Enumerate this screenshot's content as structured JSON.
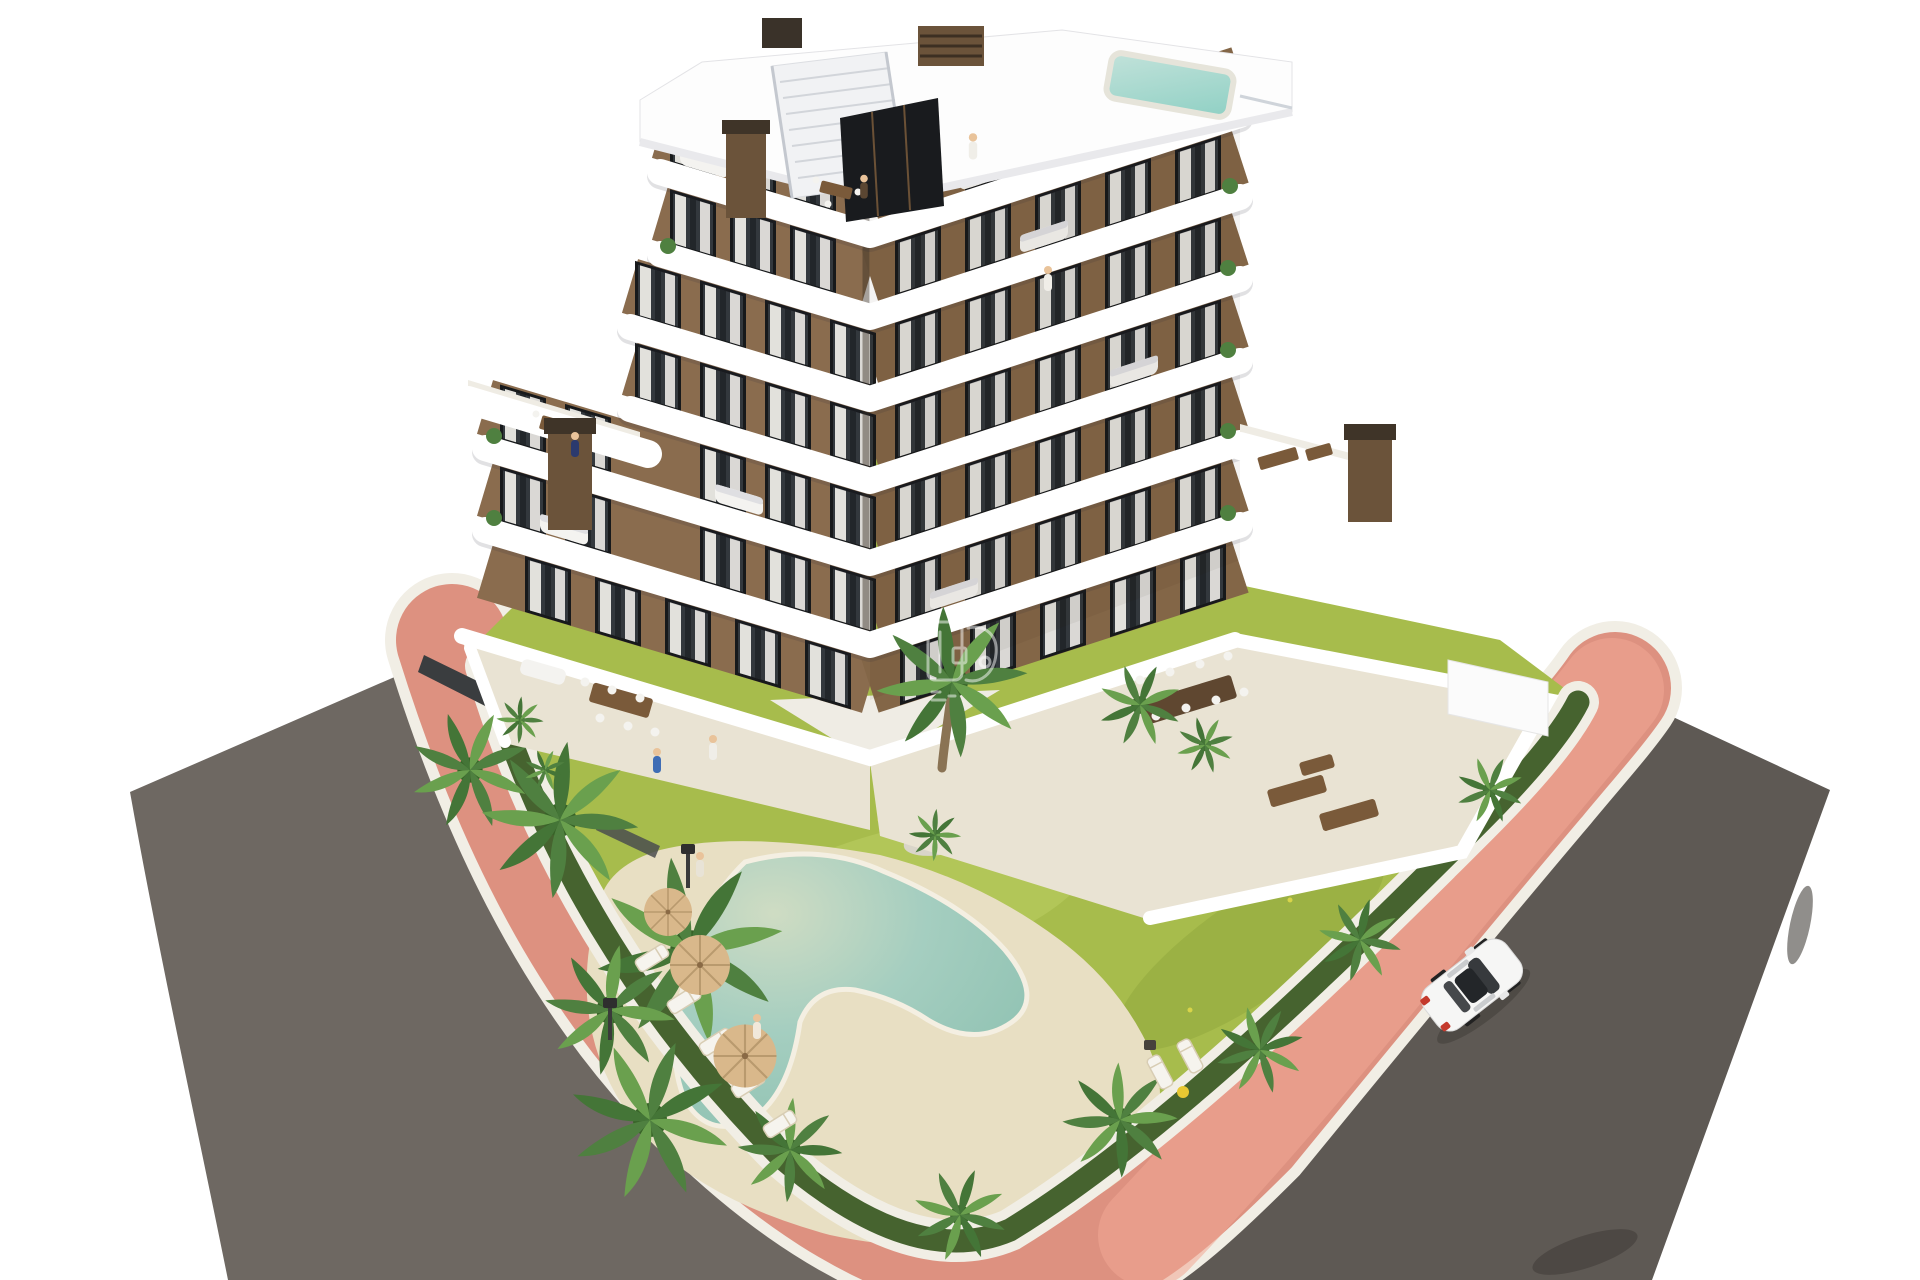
{
  "scene": {
    "title": "aerial-3d-render-of-apartment-residence-with-pool-garden-and-streets",
    "background": "#ffffff"
  },
  "palette": {
    "bg": "#ffffff",
    "road_left": "#6e6862",
    "road_right": "#5e5954",
    "sidewalk_pink": "#dd9180",
    "sidewalk_pink_light": "#f0a894",
    "curb_white": "#f1eee5",
    "lawn": "#a7bc4c",
    "lawn_light": "#bccd63",
    "lawn_dark": "#90a63c",
    "hedge": "#46632f",
    "palm_green": "#4f8040",
    "palm_light": "#6aa04e",
    "palm_dark": "#386328",
    "deck_sand": "#e8dfc3",
    "pool_shallow": "#cfdcc3",
    "pool_water": "#a5cec0",
    "pool_deep": "#8cc0b0",
    "tile": "#e9e3d3",
    "terrace_light": "#efece4",
    "slab_white": "#ffffff",
    "facade": "#8a6c4e",
    "facade_dark": "#836647",
    "window_frame": "#17191b",
    "glass": "#33383d",
    "curtain": "#eceae5",
    "wood": "#7a5a3a",
    "wood_dark": "#5f4730",
    "chimney": "#6b533a",
    "chimney_cap": "#3f3428",
    "umbrella": "#d9b88b",
    "umbrella_rib": "#b99a6e",
    "lounger": "#f6f4ee",
    "car_body": "#f6f6f5",
    "car_glass": "#26292d",
    "taillight": "#c4392c",
    "skin": "#e9c39a",
    "figure_blue": "#3f6db5",
    "figure_white": "#f0eee8",
    "gravel": "#d9d5c9",
    "stair": "#f1f2f4",
    "glassbox": "#191b1e",
    "watermark": "#ffffff"
  },
  "objects": {
    "building_label": "apartment-building",
    "floors_visible": 7,
    "car_label": "white-sedan",
    "pool_label": "free-form-swimming-pool",
    "rooftop_pool_label": "rooftop-plunge-pool",
    "garden_label": "communal-garden",
    "sidewalk_label": "pink-paved-sidewalk",
    "road_left_label": "asphalt-street-left",
    "road_right_label": "asphalt-street-right",
    "watermark_label": "faint-developer-watermark"
  }
}
